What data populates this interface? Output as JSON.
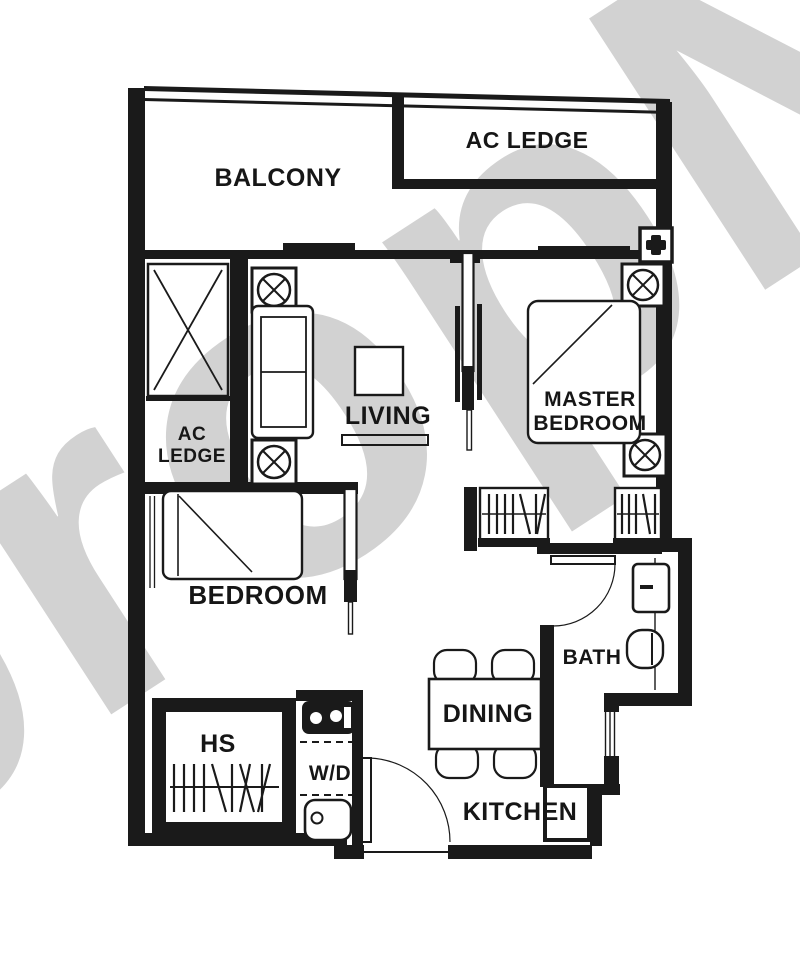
{
  "watermark": {
    "text": "propNex",
    "color": "#d2d2d2"
  },
  "colors": {
    "wall": "#1a1a1a",
    "background": "#ffffff"
  },
  "rooms": {
    "balcony": {
      "label": "BALCONY"
    },
    "ac_ledge_top": {
      "label": "AC LEDGE"
    },
    "ac_ledge_left": {
      "line1": "AC",
      "line2": "LEDGE"
    },
    "living": {
      "label": "LIVING"
    },
    "master_bedroom": {
      "line1": "MASTER",
      "line2": "BEDROOM"
    },
    "bedroom": {
      "label": "BEDROOM"
    },
    "bath": {
      "label": "BATH"
    },
    "dining": {
      "label": "DINING"
    },
    "kitchen": {
      "label": "KITCHEN"
    },
    "household_shelter": {
      "label": "HS"
    },
    "washer_dryer": {
      "label": "W/D"
    }
  }
}
